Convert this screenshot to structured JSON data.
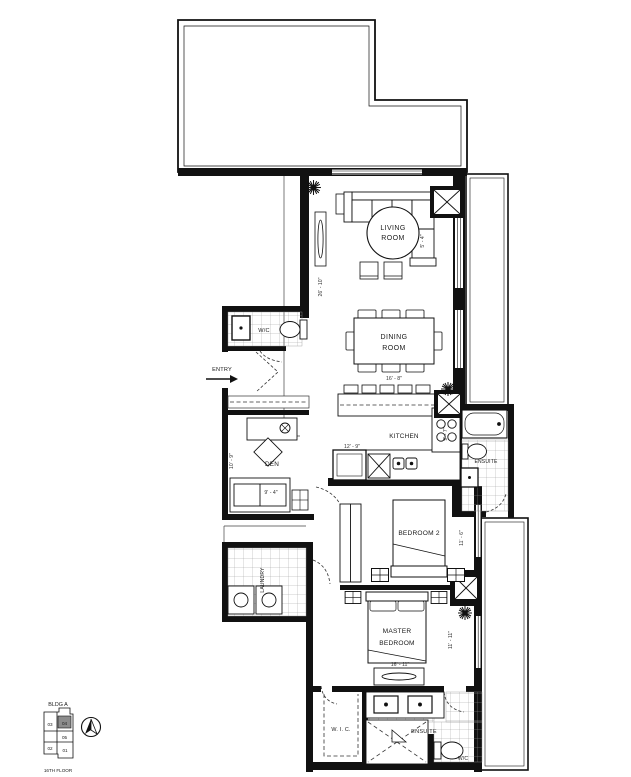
{
  "plan": {
    "rooms": {
      "living": {
        "line1": "LIVING",
        "line2": "ROOM"
      },
      "dining": {
        "line1": "DINING",
        "line2": "ROOM",
        "dim": "16' - 8\""
      },
      "kitchen": {
        "label": "KITCHEN",
        "dim_w": "12' - 9\"",
        "dim_d": "9' - 7\""
      },
      "den": {
        "label": "DEN",
        "dim_h": "10' - 9\"",
        "dim_w": "9' - 4\""
      },
      "powder": {
        "label": "W/C"
      },
      "entry": {
        "label": "ENTRY"
      },
      "bedroom2": {
        "label": "BEDROOM 2",
        "dim": "11' - 6\""
      },
      "master": {
        "line1": "MASTER",
        "line2": "BEDROOM",
        "dim_h": "11' - 11\"",
        "dim_w": "16' - 11\""
      },
      "wic": {
        "label": "W. I. C."
      },
      "ensuite2": {
        "label": "ENSUITE"
      },
      "ensuite_master": {
        "label": "ENSUITE",
        "wc": "W/C"
      },
      "laundry": {
        "label": "LAUNDRY"
      },
      "living_unit": {
        "dim_h": "26' - 10\"",
        "dim_sofa": "5' - 4\""
      }
    },
    "keyplan": {
      "building": "BLDG A",
      "floor": "16TH FLOOR",
      "units": [
        "03",
        "04",
        "05",
        "02",
        "01"
      ],
      "highlighted": "04"
    },
    "colors": {
      "wall": "#111111",
      "tile_grid": "#9a9a9a",
      "keyplan_highlight": "#8c8c8c"
    }
  }
}
